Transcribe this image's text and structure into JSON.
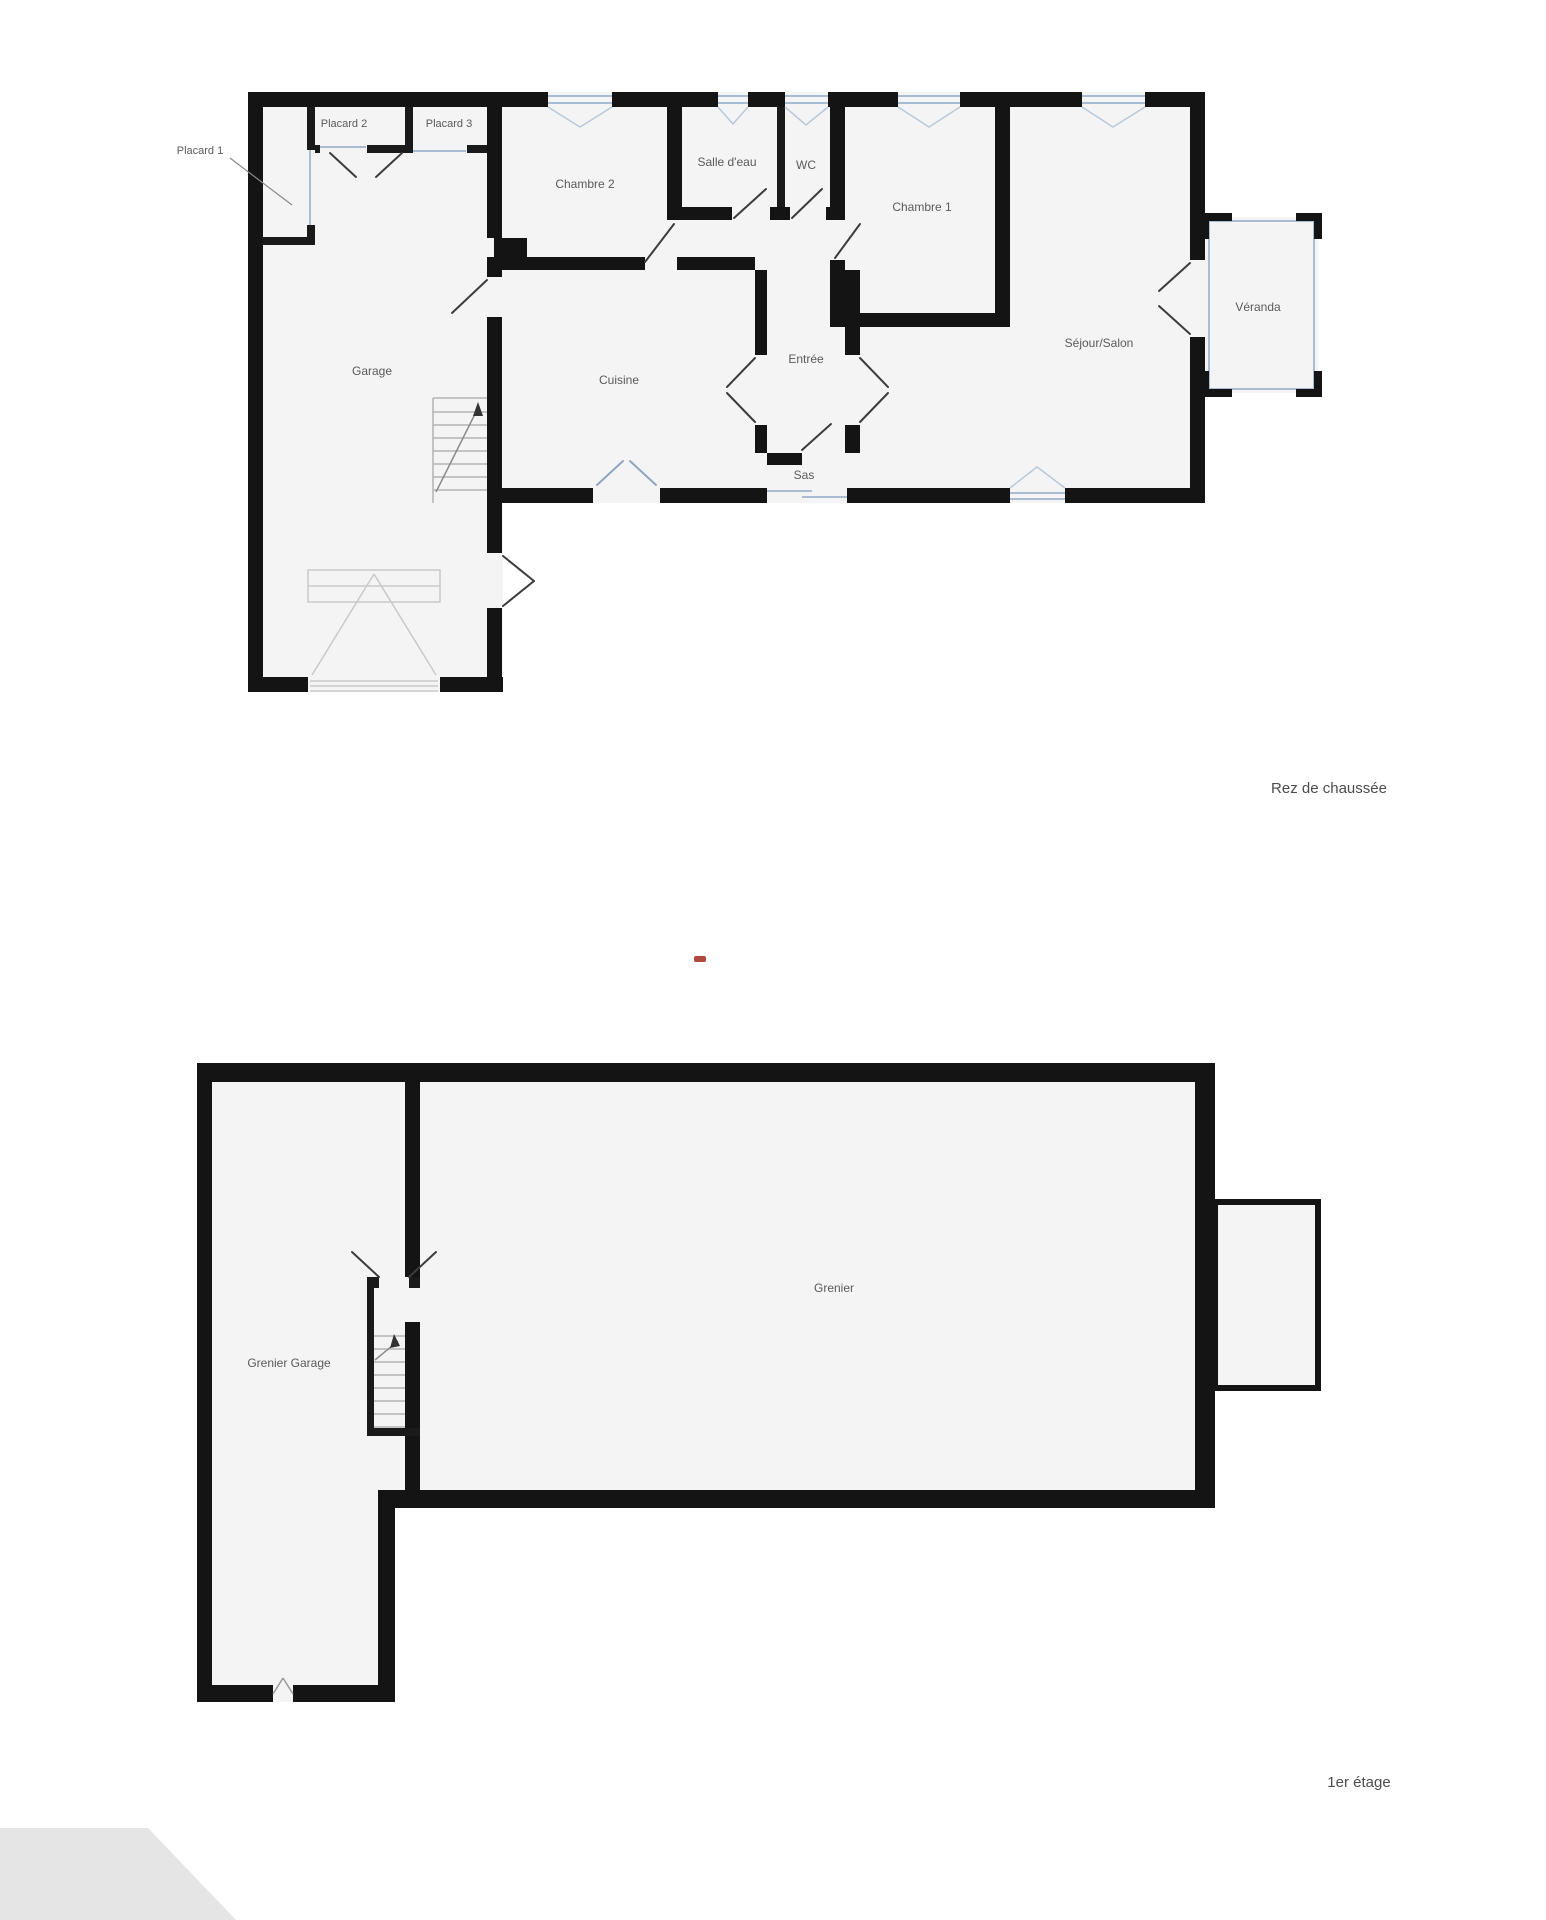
{
  "document": {
    "type": "floorplan",
    "floors_count": 2
  },
  "floor_ground": {
    "label": "Rez de chaussée",
    "rooms": {
      "placard1": "Placard 1",
      "placard2": "Placard 2",
      "placard3": "Placard 3",
      "chambre2": "Chambre 2",
      "salle_deau": "Salle d'eau",
      "wc": "WC",
      "chambre1": "Chambre 1",
      "garage": "Garage",
      "cuisine": "Cuisine",
      "entree": "Entrée",
      "sejour_salon": "Séjour/Salon",
      "veranda": "Véranda",
      "sas": "Sas"
    }
  },
  "floor_first": {
    "label": "1er étage",
    "rooms": {
      "grenier_garage": "Grenier Garage",
      "grenier": "Grenier"
    }
  },
  "colors": {
    "wall": "#141414",
    "room_fill": "#f4f4f5",
    "window_accent": "#a8bdd4",
    "door_line": "#3c3c3c",
    "label_text": "#5a5a5a",
    "red_mark": "#b2493f",
    "corner_wedge": "#e5e5e5",
    "background": "#ffffff"
  }
}
